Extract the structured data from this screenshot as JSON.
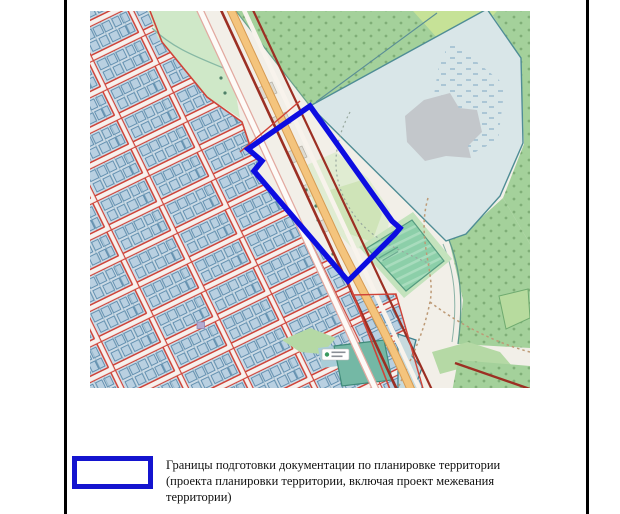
{
  "document": {
    "type": "territory-planning-figure",
    "page_background": "#ffffff",
    "frame_color": "#000000"
  },
  "map": {
    "kind": "osm-style-plan-fragment",
    "boundary_color": "#0d0de1",
    "palette": {
      "background_beige": "#f2efe8",
      "forest_green": "#a4d19b",
      "forest_dot": "#7fae77",
      "meadow_green": "#cfe8c8",
      "light_green": "#c6e297",
      "nature_area_blue": "#d9e6e8",
      "nature_border_teal": "#4f8d95",
      "gray_patch": "#c3c7cb",
      "residential_block": "#ccdbe6",
      "building_fill": "#b9d0e1",
      "building_stroke": "#4e81a5",
      "cadastral_red": "#cf4338",
      "road_orange": "#f4c47d",
      "road_dark_red": "#9c2f23",
      "cemetery_green": "#8ccfa9",
      "pond_teal": "#3d808d",
      "path_brown": "#bd9a76"
    }
  },
  "legend": {
    "swatch_color": "#1414cf",
    "lines": [
      "Границы подготовки документации по планировке территории",
      "(проекта планировки территории, включая проект межевания",
      "территории)"
    ],
    "text": "Границы подготовки документации по планировке территории (проекта планировки территории, включая проект межевания территории)"
  }
}
